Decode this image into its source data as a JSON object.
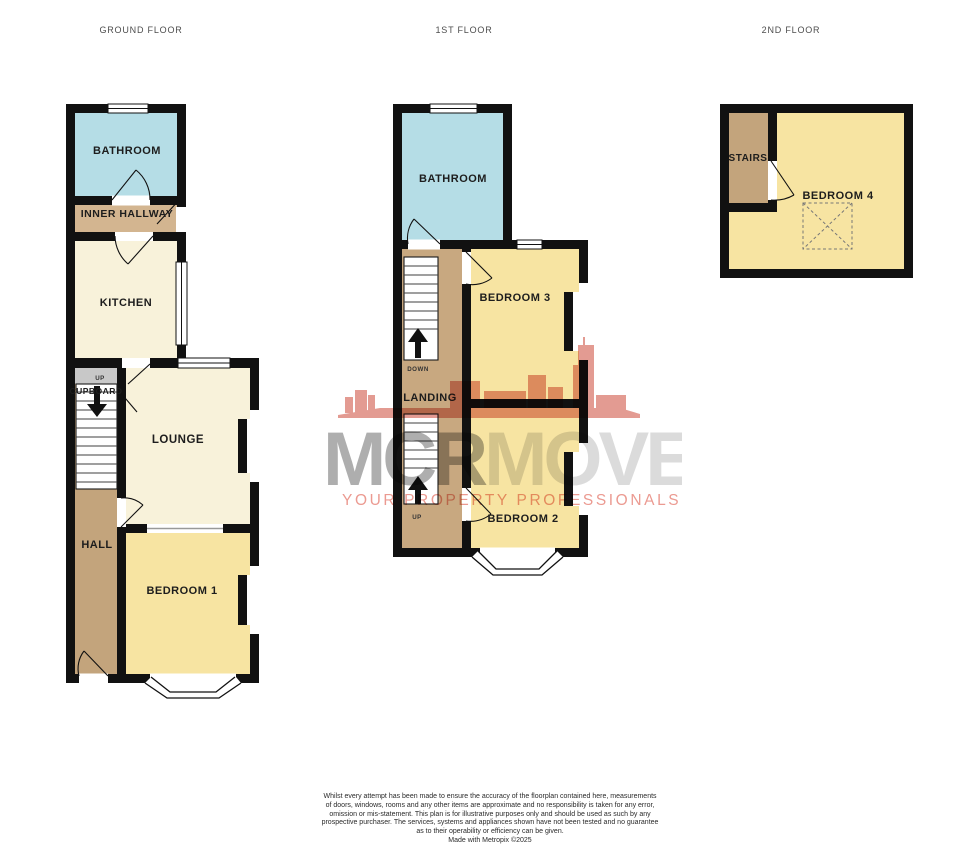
{
  "floor_headers": [
    {
      "label": "GROUND FLOOR"
    },
    {
      "label": "1ST FLOOR"
    },
    {
      "label": "2ND FLOOR"
    }
  ],
  "ground_floor": {
    "bathroom": "BATHROOM",
    "inner_hallway": "INNER HALLWAY",
    "kitchen": "KITCHEN",
    "cupboard": "CUPBOARD",
    "cupboard_up": "UP",
    "lounge": "LOUNGE",
    "hall": "HALL",
    "bedroom1": "BEDROOM 1"
  },
  "first_floor": {
    "bathroom": "BATHROOM",
    "bedroom3": "BEDROOM 3",
    "landing": "LANDING",
    "down": "DOWN",
    "up": "UP",
    "bedroom2": "BEDROOM 2"
  },
  "second_floor": {
    "stairs": "STAIRS",
    "bedroom4": "BEDROOM 4"
  },
  "watermark": {
    "brand_mcr": "MCR",
    "brand_move": "MOVE",
    "tagline": "YOUR PROPERTY PROFESSIONALS"
  },
  "footer": {
    "lines": [
      "Whilst every attempt has been made to ensure the accuracy of the floorplan contained here, measurements",
      "of doors, windows, rooms and any other items are approximate and no responsibility is taken for any error,",
      "omission or mis-statement. This plan is for illustrative purposes only and should be used as such by any",
      "prospective purchaser. The services, systems and appliances shown have not been tested and no guarantee",
      "as to their operability or efficiency can be given.",
      "Made with Metropix ©2025"
    ]
  },
  "colors": {
    "wall": "#111111",
    "bathroom_blue": "#b5dde6",
    "cream": "#f8f2da",
    "bedroom_yellow": "#f7e4a2",
    "tan_light": "#d3b590",
    "tan_mid": "#c8a880",
    "tan_dark": "#c3a47c",
    "cupboard_gray": "#c8c8c8",
    "watermark_red": "#cd4a3a",
    "watermark_gray_dark": "#7d7d7d",
    "watermark_gray_light": "#bebebe",
    "tagline_pink": "#e8897e"
  }
}
